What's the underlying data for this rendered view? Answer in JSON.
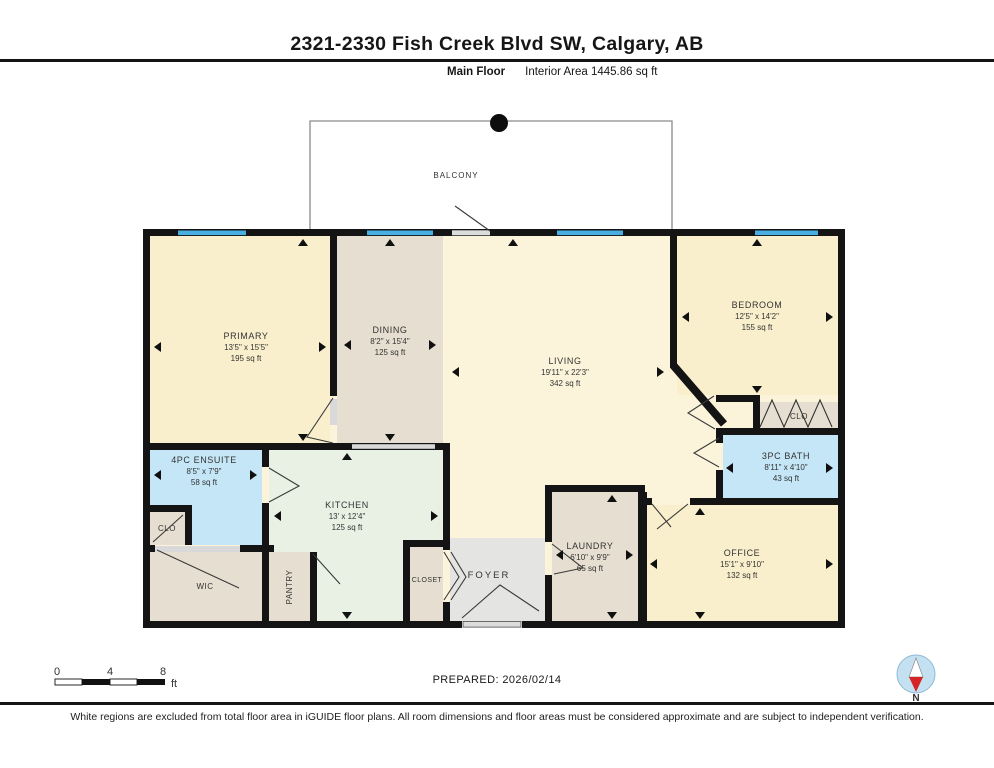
{
  "header": {
    "title": "2321-2330 Fish Creek Blvd SW, Calgary, AB",
    "floor_label": "Main Floor",
    "interior_area": "Interior Area 1445.86 sq ft"
  },
  "plan": {
    "balcony_label": "BALCONY",
    "rooms": {
      "primary": {
        "name": "PRIMARY",
        "dims": "13'5\" x 15'5\"",
        "area": "195 sq ft"
      },
      "dining": {
        "name": "DINING",
        "dims": "8'2\" x 15'4\"",
        "area": "125 sq ft"
      },
      "living": {
        "name": "LIVING",
        "dims": "19'11\" x 22'3\"",
        "area": "342 sq ft"
      },
      "bedroom": {
        "name": "BEDROOM",
        "dims": "12'5\" x 14'2\"",
        "area": "155 sq ft"
      },
      "bath": {
        "name": "3PC BATH",
        "dims": "8'11\" x 4'10\"",
        "area": "43 sq ft"
      },
      "office": {
        "name": "OFFICE",
        "dims": "15'1\" x 9'10\"",
        "area": "132 sq ft"
      },
      "laundry": {
        "name": "LAUNDRY",
        "dims": "6'10\" x 9'9\"",
        "area": "65 sq ft"
      },
      "kitchen": {
        "name": "KITCHEN",
        "dims": "13' x 12'4\"",
        "area": "125 sq ft"
      },
      "ensuite": {
        "name": "4PC ENSUITE",
        "dims": "8'5\" x 7'9\"",
        "area": "58 sq ft"
      }
    },
    "closets": {
      "clo_ensuite": "CLO",
      "wic": "WIC",
      "pantry": "PANTRY",
      "closet": "CLOSET",
      "foyer": "FOYER",
      "clo_bedroom": "CLO"
    }
  },
  "footer": {
    "scale": {
      "tick0": "0",
      "tick1": "4",
      "tick2": "8",
      "unit": "ft"
    },
    "prepared": "PREPARED: 2026/02/14",
    "compass_label": "N",
    "disclaimer": "White regions are excluded from total floor area in iGUIDE floor plans. All room dimensions and floor areas must be considered approximate and are subject to independent verification."
  },
  "colors": {
    "cream": "#F9EFCC",
    "living_cream": "#FBF4DB",
    "tan": "#E6DED0",
    "green": "#E9F1E5",
    "blue_room": "#C5E6F7",
    "gray_room": "#E4E4E3",
    "window_blue": "#49AFE3",
    "wall": "#141414"
  }
}
